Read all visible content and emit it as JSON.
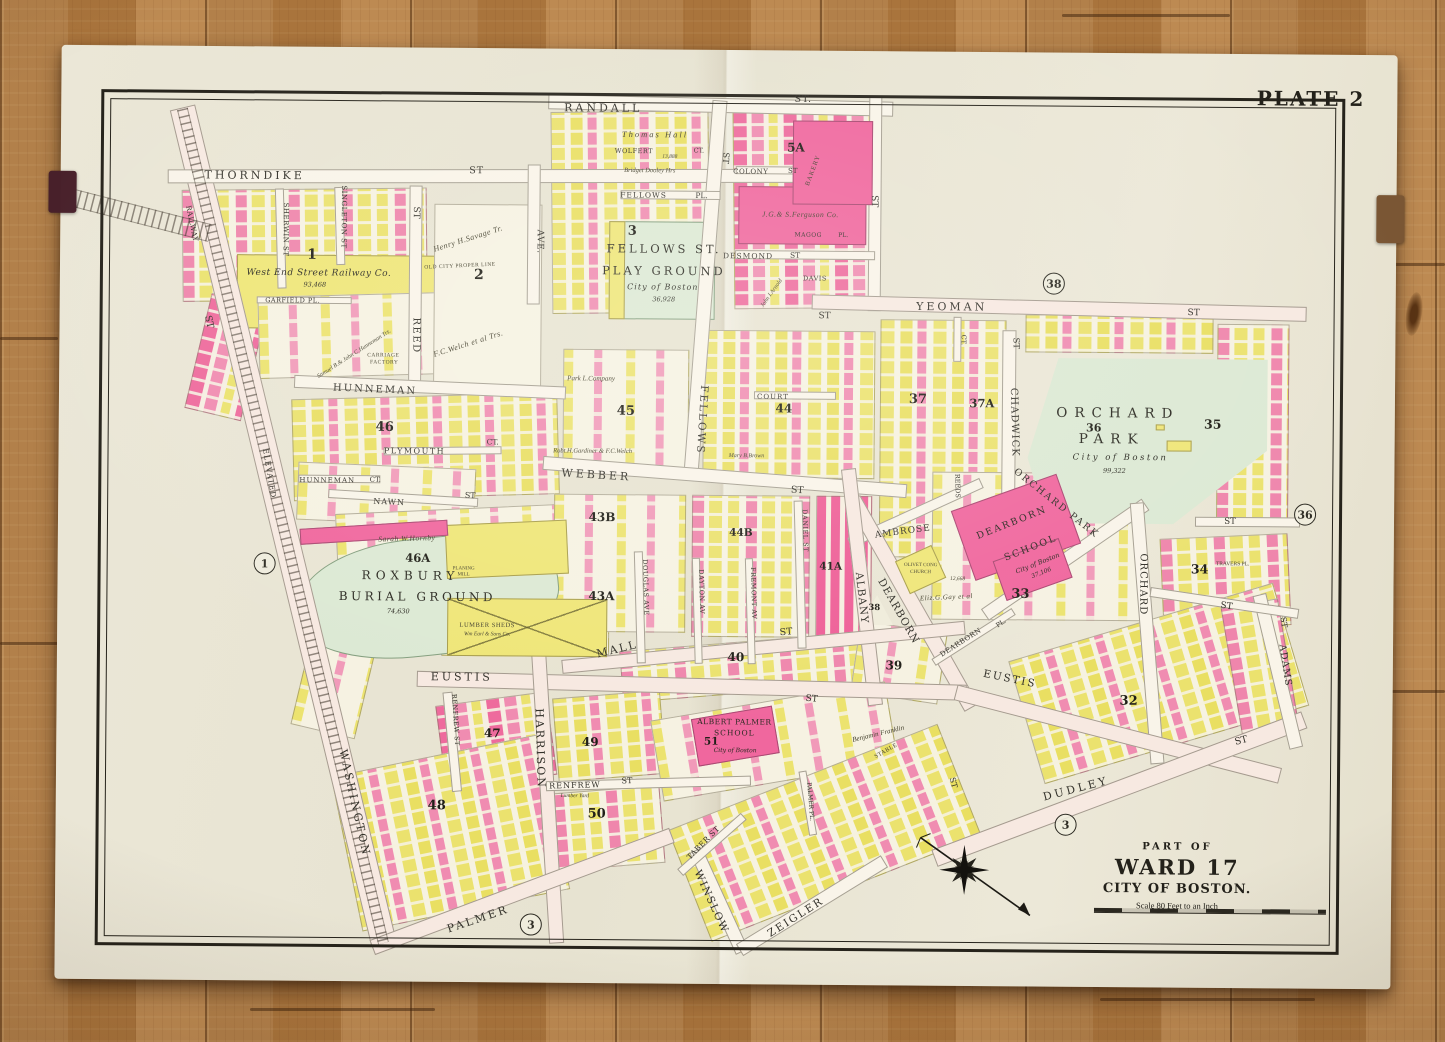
{
  "plate_label": "PLATE 2",
  "title_block": {
    "part_of": "PART OF",
    "ward": "WARD 17",
    "city": "CITY OF BOSTON.",
    "scale_text": "Scale 80 Feet to an Inch"
  },
  "palette": {
    "paper": "#eae6d5",
    "building_brick": "#f0679e",
    "building_wood": "#efe678",
    "park_green": "#dce9d4",
    "floor_wood": "#ad7a42",
    "ink": "#2b2922"
  },
  "map": {
    "street_labels": [
      {
        "t": "RANDALL",
        "x": 600,
        "y": 109,
        "s": 11,
        "w": 3
      },
      {
        "t": "ST.",
        "x": 800,
        "y": 99,
        "s": 9.5,
        "w": 1
      },
      {
        "t": "THORNDIKE",
        "x": 252,
        "y": 179,
        "s": 11,
        "w": 3
      },
      {
        "t": "ST",
        "x": 474,
        "y": 173,
        "s": 9.5,
        "w": 1
      },
      {
        "t": "FELLOWS",
        "x": 641,
        "y": 196,
        "s": 7.5,
        "w": 1
      },
      {
        "t": "PL.",
        "x": 699,
        "y": 196,
        "s": 7.5
      },
      {
        "t": "COLONY",
        "x": 748,
        "y": 172,
        "s": 7,
        "w": 0.5
      },
      {
        "t": "ST",
        "x": 790,
        "y": 171,
        "s": 7
      },
      {
        "t": "DESMOND",
        "x": 746,
        "y": 256,
        "s": 7.5,
        "w": 1
      },
      {
        "t": "ST",
        "x": 793,
        "y": 255,
        "s": 7.5
      },
      {
        "t": "MAGOG",
        "x": 806,
        "y": 235,
        "s": 6,
        "w": 0.5
      },
      {
        "t": "PL.",
        "x": 841,
        "y": 235,
        "s": 6
      },
      {
        "t": "DAVIS",
        "x": 813,
        "y": 278,
        "s": 6.5,
        "w": 0.5
      },
      {
        "t": "YEOMAN",
        "x": 950,
        "y": 305,
        "s": 11,
        "w": 3
      },
      {
        "t": "ST",
        "x": 823,
        "y": 316,
        "s": 9
      },
      {
        "t": "ST",
        "x": 1192,
        "y": 310,
        "s": 9
      },
      {
        "t": "HUNNEMAN",
        "x": 374,
        "y": 393,
        "r": 2,
        "s": 10,
        "w": 2
      },
      {
        "t": "PLYMOUTH",
        "x": 414,
        "y": 454,
        "s": 8,
        "w": 1.5
      },
      {
        "t": "CT.",
        "x": 492,
        "y": 444,
        "s": 7.5
      },
      {
        "t": "HUNNEMAN",
        "x": 327,
        "y": 484,
        "s": 7,
        "w": 1
      },
      {
        "t": "CT.",
        "x": 375,
        "y": 483,
        "s": 7
      },
      {
        "t": "NAWN",
        "x": 389,
        "y": 505,
        "r": 2,
        "s": 8,
        "w": 1
      },
      {
        "t": "ST",
        "x": 470,
        "y": 498,
        "r": 2,
        "s": 8
      },
      {
        "t": "WEBBER",
        "x": 596,
        "y": 476,
        "r": 3,
        "s": 11,
        "w": 3
      },
      {
        "t": "ST",
        "x": 797,
        "y": 490,
        "r": 3,
        "s": 9.5
      },
      {
        "t": "COURT",
        "x": 772,
        "y": 397,
        "s": 7,
        "w": 1
      },
      {
        "t": "MALL",
        "x": 618,
        "y": 650,
        "r": -14,
        "s": 11,
        "w": 2
      },
      {
        "t": "ST",
        "x": 787,
        "y": 632,
        "r": -5,
        "s": 9.5
      },
      {
        "t": "EUSTIS",
        "x": 463,
        "y": 679,
        "s": 11,
        "w": 3
      },
      {
        "t": "ST",
        "x": 813,
        "y": 699,
        "r": 4,
        "s": 9
      },
      {
        "t": "EUSTIS",
        "x": 1011,
        "y": 677,
        "r": 11,
        "s": 10.5,
        "w": 2
      },
      {
        "t": "RENFREW",
        "x": 577,
        "y": 787,
        "r": -2,
        "s": 8,
        "w": 1
      },
      {
        "t": "ST",
        "x": 629,
        "y": 782,
        "r": -2,
        "s": 8
      },
      {
        "t": "RENFREW ST",
        "x": 457,
        "y": 722,
        "r": 86,
        "s": 6.5,
        "w": 0.5
      },
      {
        "t": "PALMER",
        "x": 481,
        "y": 921,
        "r": -19,
        "s": 11,
        "w": 2.5
      },
      {
        "t": "DUDLEY",
        "x": 1078,
        "y": 786,
        "r": -15,
        "s": 11,
        "w": 3
      },
      {
        "t": "ST",
        "x": 1243,
        "y": 737,
        "r": -15,
        "s": 9.5
      },
      {
        "t": "ZEIGLER",
        "x": 799,
        "y": 917,
        "r": -33,
        "s": 10.5,
        "w": 2
      },
      {
        "t": "WINSLOW",
        "x": 714,
        "y": 902,
        "r": 65,
        "s": 10.5,
        "w": 1.5
      },
      {
        "t": "TABER ST",
        "x": 706,
        "y": 843,
        "r": -46,
        "s": 7.5,
        "w": 0.5
      },
      {
        "t": "PALMER PL.",
        "x": 812,
        "y": 801,
        "r": 85,
        "s": 6
      },
      {
        "t": "WASHINGTON",
        "x": 357,
        "y": 806,
        "r": 77,
        "s": 11,
        "w": 2.5
      },
      {
        "t": "ST",
        "x": 207,
        "y": 326,
        "r": 77,
        "s": 9.5
      },
      {
        "t": "ELEVATED",
        "x": 269,
        "y": 477,
        "r": 80,
        "s": 7.5,
        "w": 1
      },
      {
        "t": "RAILWAY",
        "x": 189,
        "y": 228,
        "r": 78,
        "s": 7,
        "w": 0.5
      },
      {
        "t": "REED",
        "x": 414,
        "y": 338,
        "r": 90,
        "s": 10,
        "w": 1.5
      },
      {
        "t": "ST",
        "x": 413,
        "y": 215,
        "r": 90,
        "s": 9
      },
      {
        "t": "SHERWIN ST",
        "x": 283,
        "y": 233,
        "r": 90,
        "s": 7,
        "w": 0.5
      },
      {
        "t": "SINGLETON ST",
        "x": 341,
        "y": 220,
        "r": 90,
        "s": 7,
        "w": 0.5
      },
      {
        "t": "AVE.",
        "x": 537,
        "y": 243,
        "r": 90,
        "s": 9,
        "w": 0.5
      },
      {
        "t": "FELLOWS",
        "x": 701,
        "y": 420,
        "r": 93,
        "s": 10.5,
        "w": 2
      },
      {
        "t": "ST",
        "x": 722,
        "y": 158,
        "r": 93,
        "s": 8.5
      },
      {
        "t": "ST",
        "x": 871,
        "y": 200,
        "r": 90,
        "s": 9
      },
      {
        "t": "HARRISON",
        "x": 542,
        "y": 750,
        "r": 88,
        "s": 11,
        "w": 2
      },
      {
        "t": "ALBANY",
        "x": 862,
        "y": 597,
        "r": 83,
        "s": 10.5,
        "w": 1
      },
      {
        "t": "DEARBORN",
        "x": 899,
        "y": 610,
        "r": 60,
        "s": 10.5,
        "w": 1
      },
      {
        "t": "AMBROSE",
        "x": 903,
        "y": 531,
        "r": -8,
        "s": 9,
        "w": 1
      },
      {
        "t": "REEDS",
        "x": 957,
        "y": 484,
        "r": 88,
        "s": 6.5
      },
      {
        "t": "CHADWICK",
        "x": 1013,
        "y": 420,
        "r": 88,
        "s": 10,
        "w": 1
      },
      {
        "t": "ST",
        "x": 1014,
        "y": 341,
        "r": 88,
        "s": 8.5
      },
      {
        "t": "ORCHARD PARK",
        "x": 1056,
        "y": 501,
        "r": 38,
        "s": 9.5,
        "w": 2
      },
      {
        "t": "ORCHARD",
        "x": 1143,
        "y": 581,
        "r": 90,
        "s": 10,
        "w": 1
      },
      {
        "t": "DEARBORN",
        "x": 962,
        "y": 641,
        "r": -33,
        "s": 7,
        "w": 0.5
      },
      {
        "t": "PL.",
        "x": 1002,
        "y": 621,
        "r": -33,
        "s": 6.5
      },
      {
        "t": "ADAMS",
        "x": 1286,
        "y": 661,
        "r": 81,
        "s": 9.5,
        "w": 1
      },
      {
        "t": "ST",
        "x": 1284,
        "y": 618,
        "r": 81,
        "s": 8
      },
      {
        "t": "ST",
        "x": 1227,
        "y": 603,
        "r": 8,
        "s": 9
      },
      {
        "t": "ST",
        "x": 1230,
        "y": 518,
        "s": 8.5
      },
      {
        "t": "ST",
        "x": 955,
        "y": 781,
        "r": 75,
        "s": 8
      },
      {
        "t": "GARFIELD PL.",
        "x": 291,
        "y": 304,
        "s": 6.5,
        "w": 0.5
      },
      {
        "t": "CT.",
        "x": 962,
        "y": 338,
        "r": 90,
        "s": 6.5
      },
      {
        "t": "DOUGLAS AVE",
        "x": 646,
        "y": 588,
        "r": 88,
        "s": 6.5,
        "w": 0.5
      },
      {
        "t": "DAYTON AV",
        "x": 702,
        "y": 592,
        "r": 88,
        "s": 6.5,
        "w": 0.5
      },
      {
        "t": "FREMONT AV",
        "x": 754,
        "y": 593,
        "r": 88,
        "s": 6.5,
        "w": 0.5
      },
      {
        "t": "DANIEL ST",
        "x": 805,
        "y": 530,
        "r": 88,
        "s": 6.5,
        "w": 0.5
      },
      {
        "t": "WOLFERT",
        "x": 631,
        "y": 152,
        "s": 6.5,
        "w": 0.5
      },
      {
        "t": "CT.",
        "x": 696,
        "y": 151,
        "s": 6.5
      }
    ],
    "block_numbers": [
      {
        "t": "1",
        "x": 310,
        "y": 258,
        "s": 14
      },
      {
        "t": "2",
        "x": 477,
        "y": 277,
        "s": 14
      },
      {
        "t": "3",
        "x": 630,
        "y": 232,
        "s": 13
      },
      {
        "t": "5A",
        "x": 793,
        "y": 147,
        "s": 12
      },
      {
        "t": "32",
        "x": 1130,
        "y": 698,
        "s": 13
      },
      {
        "t": "33",
        "x": 1021,
        "y": 592,
        "s": 13
      },
      {
        "t": "34",
        "x": 1200,
        "y": 566,
        "s": 12.5
      },
      {
        "t": "35",
        "x": 1212,
        "y": 421,
        "s": 12.5
      },
      {
        "t": "36",
        "x": 1093,
        "y": 425,
        "s": 11
      },
      {
        "t": "37",
        "x": 917,
        "y": 398,
        "s": 13
      },
      {
        "t": "37A",
        "x": 981,
        "y": 402,
        "s": 11.5
      },
      {
        "t": "38",
        "x": 875,
        "y": 607,
        "s": 8.5
      },
      {
        "t": "39",
        "x": 895,
        "y": 664,
        "s": 12
      },
      {
        "t": "40",
        "x": 737,
        "y": 657,
        "s": 12
      },
      {
        "t": "41A",
        "x": 831,
        "y": 566,
        "s": 10.5
      },
      {
        "t": "43A",
        "x": 602,
        "y": 597,
        "s": 12
      },
      {
        "t": "43B",
        "x": 602,
        "y": 518,
        "s": 12
      },
      {
        "t": "44",
        "x": 783,
        "y": 408,
        "s": 12
      },
      {
        "t": "44B",
        "x": 741,
        "y": 533,
        "s": 10.5
      },
      {
        "t": "45",
        "x": 625,
        "y": 412,
        "s": 13
      },
      {
        "t": "46",
        "x": 384,
        "y": 430,
        "s": 13
      },
      {
        "t": "46A",
        "x": 418,
        "y": 561,
        "s": 11.5
      },
      {
        "t": "47",
        "x": 494,
        "y": 735,
        "s": 12
      },
      {
        "t": "48",
        "x": 439,
        "y": 808,
        "s": 13
      },
      {
        "t": "49",
        "x": 592,
        "y": 743,
        "s": 12
      },
      {
        "t": "50",
        "x": 599,
        "y": 815,
        "s": 13
      },
      {
        "t": "51",
        "x": 713,
        "y": 742,
        "s": 10.5
      }
    ],
    "circled_refs": [
      {
        "t": "1",
        "x": 265,
        "y": 567
      },
      {
        "t": "3",
        "x": 534,
        "y": 926
      },
      {
        "t": "3",
        "x": 1068,
        "y": 822
      },
      {
        "t": "38",
        "x": 1052,
        "y": 281
      },
      {
        "t": "36",
        "x": 1305,
        "y": 510
      }
    ],
    "place_labels": [
      {
        "t": "FELLOWS ST.",
        "x": 662,
        "y": 250,
        "s": 11.5,
        "w": 3
      },
      {
        "t": "PLAY GROUND",
        "x": 662,
        "y": 272,
        "s": 11.5,
        "w": 3
      },
      {
        "t": "City of Boston",
        "x": 661,
        "y": 288,
        "s": 8,
        "w": 1,
        "i": 1
      },
      {
        "t": "36,928",
        "x": 662,
        "y": 300,
        "s": 6.5,
        "i": 1
      },
      {
        "t": "ORCHARD",
        "x": 1117,
        "y": 411,
        "s": 13.5,
        "w": 7
      },
      {
        "t": "PARK",
        "x": 1111,
        "y": 437,
        "s": 13.5,
        "w": 7
      },
      {
        "t": "City of Boston",
        "x": 1120,
        "y": 455,
        "s": 8.5,
        "w": 2.5,
        "i": 1
      },
      {
        "t": "99,322",
        "x": 1114,
        "y": 468,
        "s": 6.5,
        "i": 1
      },
      {
        "t": "ROXBURY",
        "x": 411,
        "y": 578,
        "s": 12,
        "w": 5
      },
      {
        "t": "BURIAL GROUND",
        "x": 418,
        "y": 599,
        "s": 12,
        "w": 3.5
      },
      {
        "t": "74,630",
        "x": 399,
        "y": 614,
        "s": 6.5,
        "i": 1
      },
      {
        "t": "DEARBORN",
        "x": 1012,
        "y": 521,
        "r": -22,
        "s": 9.5,
        "w": 2
      },
      {
        "t": "SCHOOL",
        "x": 1031,
        "y": 546,
        "r": -22,
        "s": 9.5,
        "w": 2
      },
      {
        "t": "City of Boston",
        "x": 1038,
        "y": 561,
        "r": -22,
        "s": 6.5,
        "i": 1
      },
      {
        "t": "37,106",
        "x": 1042,
        "y": 571,
        "r": -22,
        "s": 6,
        "i": 1
      },
      {
        "t": "ALBERT PALMER",
        "x": 736,
        "y": 722,
        "s": 7.5,
        "w": 0.5
      },
      {
        "t": "SCHOOL",
        "x": 736,
        "y": 733,
        "s": 7.5,
        "w": 1
      },
      {
        "t": "City of Boston",
        "x": 737,
        "y": 751,
        "s": 6,
        "i": 1
      },
      {
        "t": "West End Street Railway Co.",
        "x": 317,
        "y": 277,
        "s": 9,
        "w": 0.5,
        "i": 1
      },
      {
        "t": "93,468",
        "x": 313,
        "y": 288,
        "s": 6.5,
        "i": 1
      }
    ],
    "owner_notes": [
      {
        "t": "Thomas Hall",
        "x": 652,
        "y": 135,
        "s": 8.5,
        "w": 2,
        "i": 1
      },
      {
        "t": "Bridget Dooley Hrs",
        "x": 647,
        "y": 172,
        "s": 6.5,
        "i": 1
      },
      {
        "t": "13,888",
        "x": 667,
        "y": 158,
        "s": 5.5,
        "i": 1
      },
      {
        "t": "J.G.& S.Ferguson Co.",
        "x": 798,
        "y": 214,
        "s": 7.5,
        "w": 0.5,
        "i": 1
      },
      {
        "t": "BAKERY",
        "x": 811,
        "y": 170,
        "r": -70,
        "s": 6.5,
        "w": 1
      },
      {
        "t": "Henry H.Savage Tr.",
        "x": 466,
        "y": 241,
        "r": -18,
        "s": 8,
        "w": 0.5,
        "i": 1
      },
      {
        "t": "OLD CITY PROPER LINE",
        "x": 458,
        "y": 269,
        "r": -3,
        "s": 5.5,
        "w": 0.5
      },
      {
        "t": "F.C.Welch et al Trs.",
        "x": 467,
        "y": 346,
        "r": -18,
        "s": 8,
        "w": 0.5,
        "i": 1
      },
      {
        "t": "CARRIAGE",
        "x": 382,
        "y": 359,
        "s": 5.5,
        "w": 0.5
      },
      {
        "t": "FACTORY",
        "x": 383,
        "y": 366,
        "s": 5.5,
        "w": 0.5
      },
      {
        "t": "Samuel B.& John C.Hunneman Trs.",
        "x": 353,
        "y": 357,
        "r": -33,
        "s": 6,
        "i": 1
      },
      {
        "t": "Robt.H.Gardiner & F.C.Welch",
        "x": 592,
        "y": 453,
        "s": 6.5,
        "i": 1
      },
      {
        "t": "Park L.Company",
        "x": 590,
        "y": 380,
        "s": 7,
        "i": 1
      },
      {
        "t": "Sarah W.Hornby",
        "x": 407,
        "y": 541,
        "r": -2,
        "s": 7.5,
        "w": 0.5,
        "i": 1
      },
      {
        "t": "LUMBER SHEDS",
        "x": 488,
        "y": 628,
        "s": 6.5,
        "w": 0.5
      },
      {
        "t": "Wm Earl & Sons Co.",
        "x": 488,
        "y": 637,
        "s": 5.5,
        "i": 1
      },
      {
        "t": "PLANING",
        "x": 464,
        "y": 571,
        "s": 5
      },
      {
        "t": "MILL",
        "x": 464,
        "y": 577,
        "s": 5
      },
      {
        "t": "OLIVET CONG",
        "x": 921,
        "y": 564,
        "s": 5
      },
      {
        "t": "CHURCH",
        "x": 921,
        "y": 571,
        "s": 5
      },
      {
        "t": "12,668",
        "x": 958,
        "y": 578,
        "s": 5.5,
        "i": 1
      },
      {
        "t": "Eliz.G.Gay et al",
        "x": 947,
        "y": 596,
        "r": -3,
        "s": 7,
        "w": 0.5,
        "i": 1
      },
      {
        "t": "Benjamin Franklin",
        "x": 880,
        "y": 733,
        "r": -14,
        "s": 7,
        "i": 1
      },
      {
        "t": "STABLE",
        "x": 888,
        "y": 750,
        "r": -30,
        "s": 6,
        "w": 0.5
      },
      {
        "t": "Lumber Yard",
        "x": 577,
        "y": 798,
        "s": 5.5,
        "i": 1
      },
      {
        "t": "John I.Arnold",
        "x": 770,
        "y": 293,
        "r": -55,
        "s": 6,
        "i": 1
      },
      {
        "t": "Mary B.Brown",
        "x": 746,
        "y": 456,
        "s": 6,
        "i": 1
      },
      {
        "t": "TRAVERS PL.",
        "x": 1233,
        "y": 561,
        "s": 5.5
      }
    ]
  }
}
